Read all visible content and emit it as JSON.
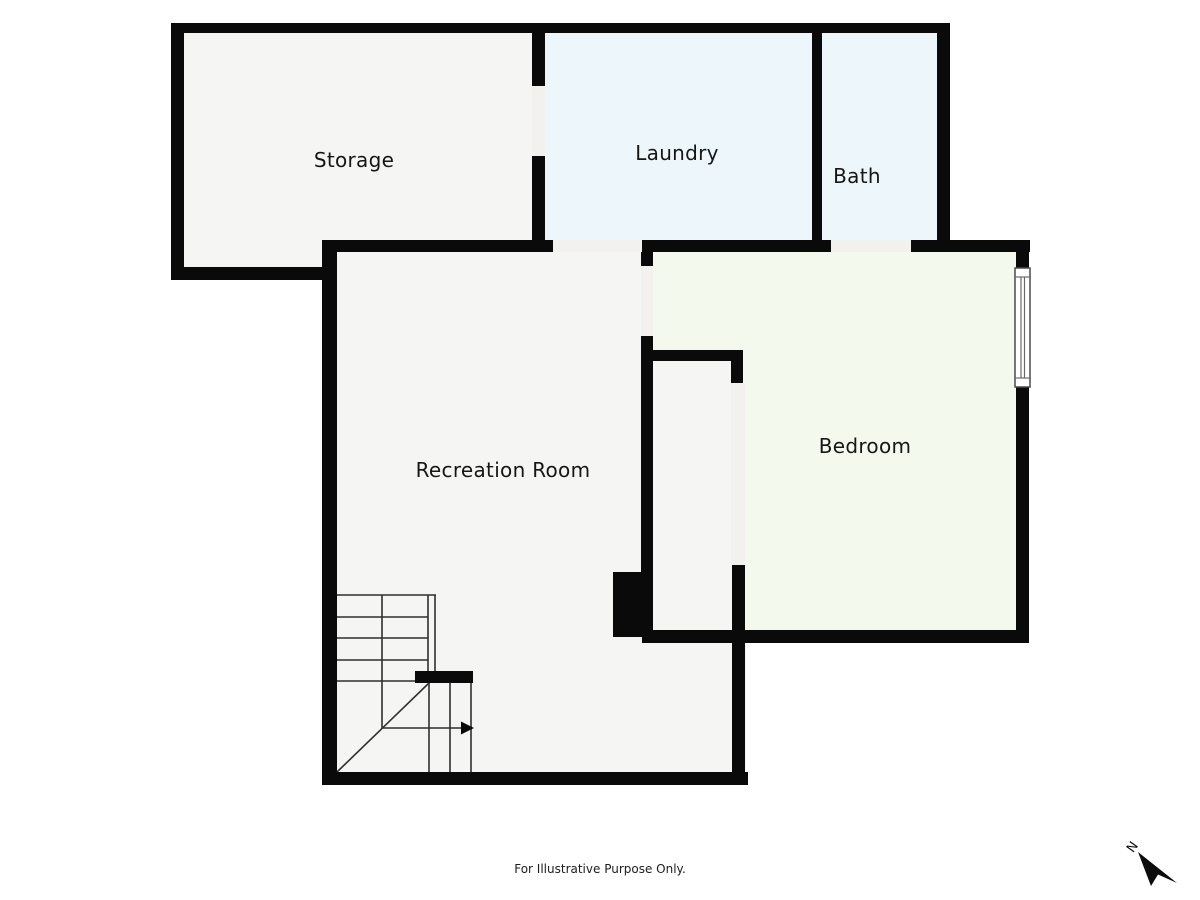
{
  "rooms": [
    {
      "id": "storage",
      "label": "Storage"
    },
    {
      "id": "laundry",
      "label": "Laundry"
    },
    {
      "id": "bath",
      "label": "Bath"
    },
    {
      "id": "recreation",
      "label": "Recreation Room"
    },
    {
      "id": "bedroom",
      "label": "Bedroom"
    }
  ],
  "footer": {
    "text": "For Illustrative Purpose Only."
  },
  "compass": {
    "label": "N"
  },
  "features": {
    "staircase": "winder-stairs-with-right-direction-arrow",
    "window": "bedroom-east-wall",
    "structural_block": "between-recreation-room-and-closet"
  },
  "colors": {
    "wall": "#0a0a0a",
    "gray": "#f5f5f3",
    "blue": "#edf6fb",
    "green": "#f3f9ec",
    "opening": "#f2f1ee",
    "line": "#2f2f2f",
    "text": "#161616"
  }
}
